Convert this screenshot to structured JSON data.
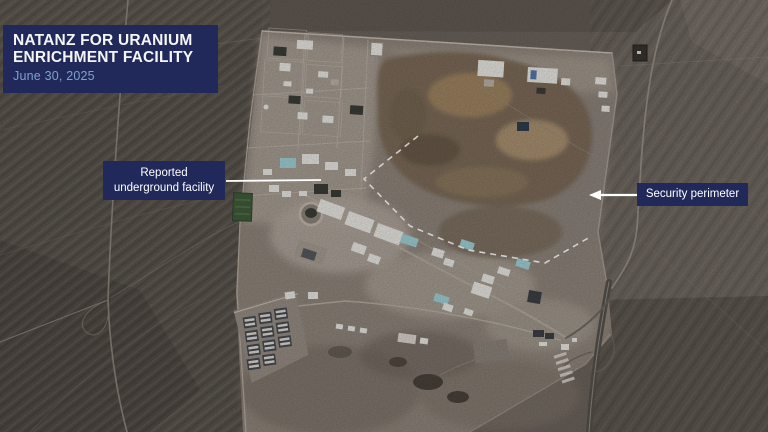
{
  "header": {
    "title_line1": "NATANZ FOR URANIUM",
    "title_line2": "ENRICHMENT FACILITY",
    "date": "June 30, 2025"
  },
  "annotations": {
    "underground_line1": "Reported",
    "underground_line2": "underground facility",
    "perimeter_label": "Security perimeter"
  },
  "colors": {
    "card-bg": "#20295a",
    "date-text": "#7fa0d0",
    "annotation-line": "#ffffff",
    "desert-dark": "#57504a",
    "desert-light": "#6f6860",
    "compound": "#8f857b",
    "mound-brown": "#7c6b58",
    "building-white": "#e9e7e2",
    "building-cyan": "#9fd0d6",
    "field-green": "#3f5c39"
  }
}
